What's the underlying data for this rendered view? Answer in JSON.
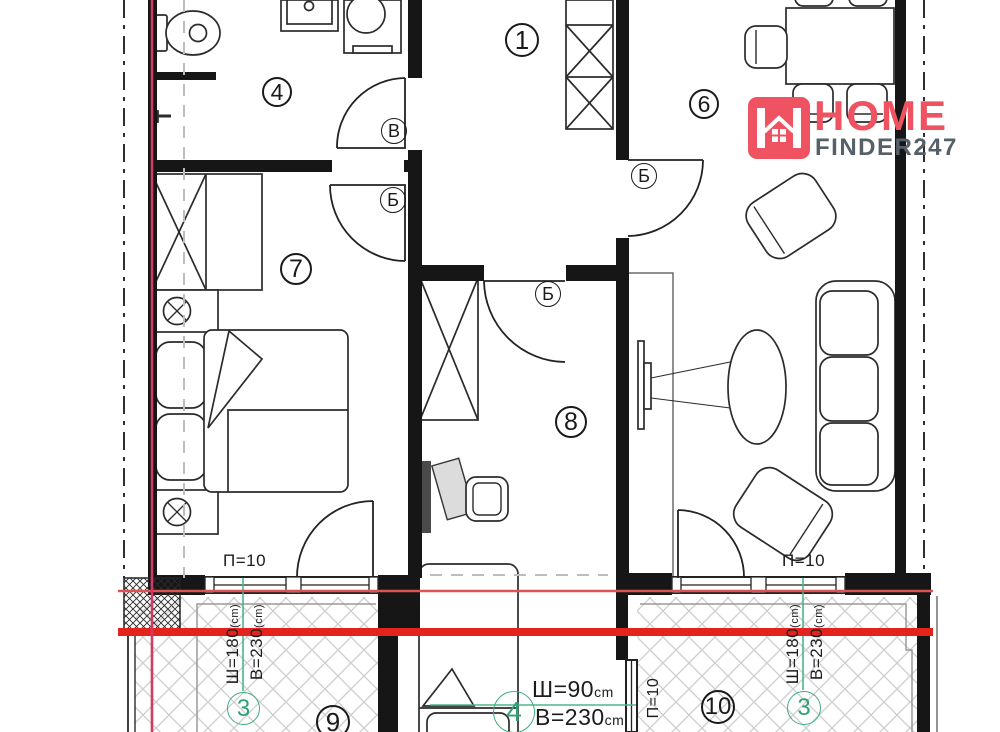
{
  "logo": {
    "line1": "HOME",
    "line2": "FINDER247"
  },
  "colors": {
    "section_red": "#e3231c",
    "marker_pink": "#d03a66",
    "annotation_green": "#3fae7e",
    "logo_pink": "#ef5361",
    "logo_gray": "#566068"
  },
  "rooms": {
    "hallway": "1",
    "bathroom": "4",
    "living": "6",
    "bedroom": "7",
    "office": "8",
    "balcony_left": "9",
    "balcony_right": "10"
  },
  "doors": {
    "bathroom": "В",
    "bedroom": "Б",
    "living": "Б",
    "office": "Б"
  },
  "windows": {
    "parapet_left": "П=10",
    "parapet_right": "П=10",
    "parapet_mid": "П=10",
    "left_width": "Ш=180",
    "left_width_unit": "(cm)",
    "left_height": "В=230",
    "left_height_unit": "(cm)",
    "right_width": "Ш=180",
    "right_width_unit": "(cm)",
    "right_height": "В=230",
    "right_height_unit": "(cm)",
    "type_left": "3",
    "type_right": "3"
  },
  "balcony_door": {
    "width": "Ш=90",
    "width_unit": "cm",
    "height": "В=230",
    "height_unit": "cm",
    "type": "4"
  }
}
